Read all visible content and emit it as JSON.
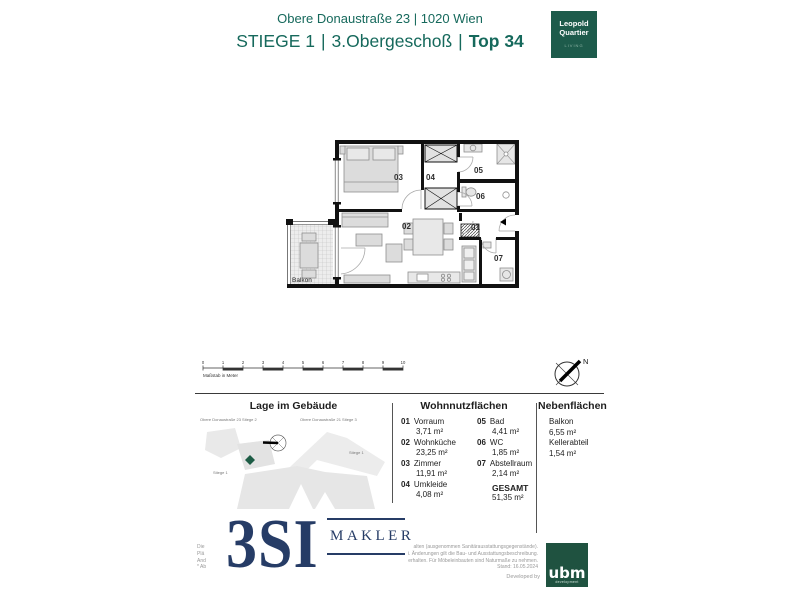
{
  "header": {
    "address": "Obere Donaustraße 23 | 1020 Wien",
    "stiege": "STIEGE 1",
    "floor": "3.Obergeschoß",
    "top": "Top 34",
    "separator": "|"
  },
  "logos": {
    "leopold": {
      "line1": "Leopold",
      "line2": "Quartier",
      "line3": "LIVING"
    },
    "brand_3si": {
      "big": "3SI",
      "sub": "MAKLER"
    },
    "ubm": {
      "name": "ubm",
      "sub": "development"
    },
    "developed_by": "Developed by"
  },
  "plan": {
    "balkon": "Balkon",
    "r1": "01",
    "r2": "02",
    "r3": "03",
    "r4": "04",
    "r5": "05",
    "r6": "06",
    "r7": "07"
  },
  "scale": {
    "ticks": [
      "0",
      "1",
      "2",
      "3",
      "4",
      "5",
      "6",
      "7",
      "8",
      "9",
      "10"
    ],
    "label": "Maßstab in Meter"
  },
  "compass": {
    "north": "N"
  },
  "site_plan": {
    "title": "Lage im Gebäude",
    "label_left": "Obere Donaustraße 23 Stiege 2",
    "label_right": "Obere Donaustraße 21 Stiege 3",
    "stiege_a": "Stiege 1",
    "stiege_b": "Stiege 1"
  },
  "areas": {
    "title": "Wohnnutzflächen",
    "rooms": [
      {
        "num": "01",
        "name": "Vorraum",
        "area": "3,71 m²"
      },
      {
        "num": "02",
        "name": "Wohnküche",
        "area": "23,25 m²"
      },
      {
        "num": "03",
        "name": "Zimmer",
        "area": "11,91 m²"
      },
      {
        "num": "04",
        "name": "Umkleide",
        "area": "4,08 m²"
      },
      {
        "num": "05",
        "name": "Bad",
        "area": "4,41 m²"
      },
      {
        "num": "06",
        "name": "WC",
        "area": "1,85 m²"
      },
      {
        "num": "07",
        "name": "Abstellraum",
        "area": "2,14 m²"
      }
    ],
    "total_label": "GESAMT",
    "total_area": "51,35 m²"
  },
  "side_areas": {
    "title": "Nebenflächen",
    "items": [
      {
        "name": "Balkon",
        "area": "6,55 m²"
      },
      {
        "name": "Kellerabteil",
        "area": "1,54 m²"
      }
    ]
  },
  "footer": {
    "left_fragments": [
      "Die",
      "Plä",
      "And",
      "* Ab"
    ],
    "right_fragments": [
      "alten (ausgenommen Sanitärausstattungsgegenstände).",
      "i. Änderungen gilt die Bau- und Ausstattungsbeschreibung.",
      "erhalten. Für Möbeleinbauten sind Naturmaße zu nehmen.",
      "Stand: 16.05.2024"
    ]
  }
}
